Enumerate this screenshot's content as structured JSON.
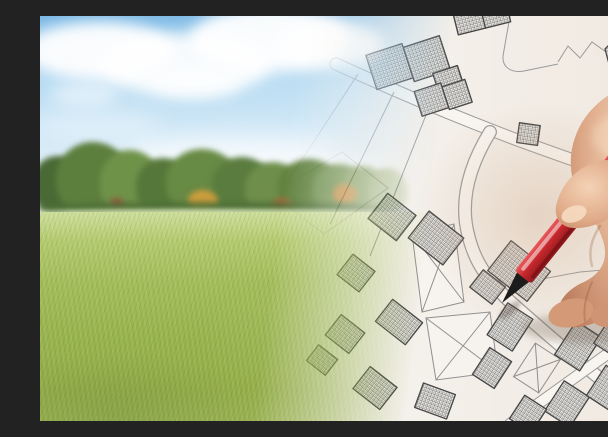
{
  "image": {
    "type": "stock-photo-composite",
    "alt": "Empty green meadow with a tree line and blue cloudy sky blending into an imaginary hand-drawn cadastral map; a hand holds a red pencil pointing at a hatched building plot",
    "width_px": 608,
    "height_px": 405
  },
  "scene": {
    "left_half": {
      "name": "meadow-photo",
      "description": "green grass field, row of trees with a few autumn-orange bushes, blue sky with white cumulus clouds and haze at the horizon"
    },
    "right_half": {
      "name": "cadastral-map-drawing",
      "description": "imaginary city map: parcel boundary lines, winding white roads, buildings filled with cross-hatch, vacant parcels marked with an X, rotated block grid in lower right corner"
    },
    "foreground": {
      "name": "hand-with-red-pencil",
      "description": "right hand entering from the right edge holding a red pencil with black tip touching a hatched building on the map"
    }
  },
  "palette": {
    "sky_blue": "#9ccbec",
    "cloud_white": "#ffffff",
    "grass_green": "#9ab455",
    "tree_green": "#5f8040",
    "autumn_orange": "#c9973d",
    "paper": "#f5f2ed",
    "road_white": "#f8f5f0",
    "map_line_gray": "#9a9a9a",
    "building_line": "#454545",
    "pencil_red": "#c4272c",
    "pencil_tip_black": "#1c1c1c",
    "skin": "#d9a180",
    "skin_shadow": "#b97c5c"
  }
}
